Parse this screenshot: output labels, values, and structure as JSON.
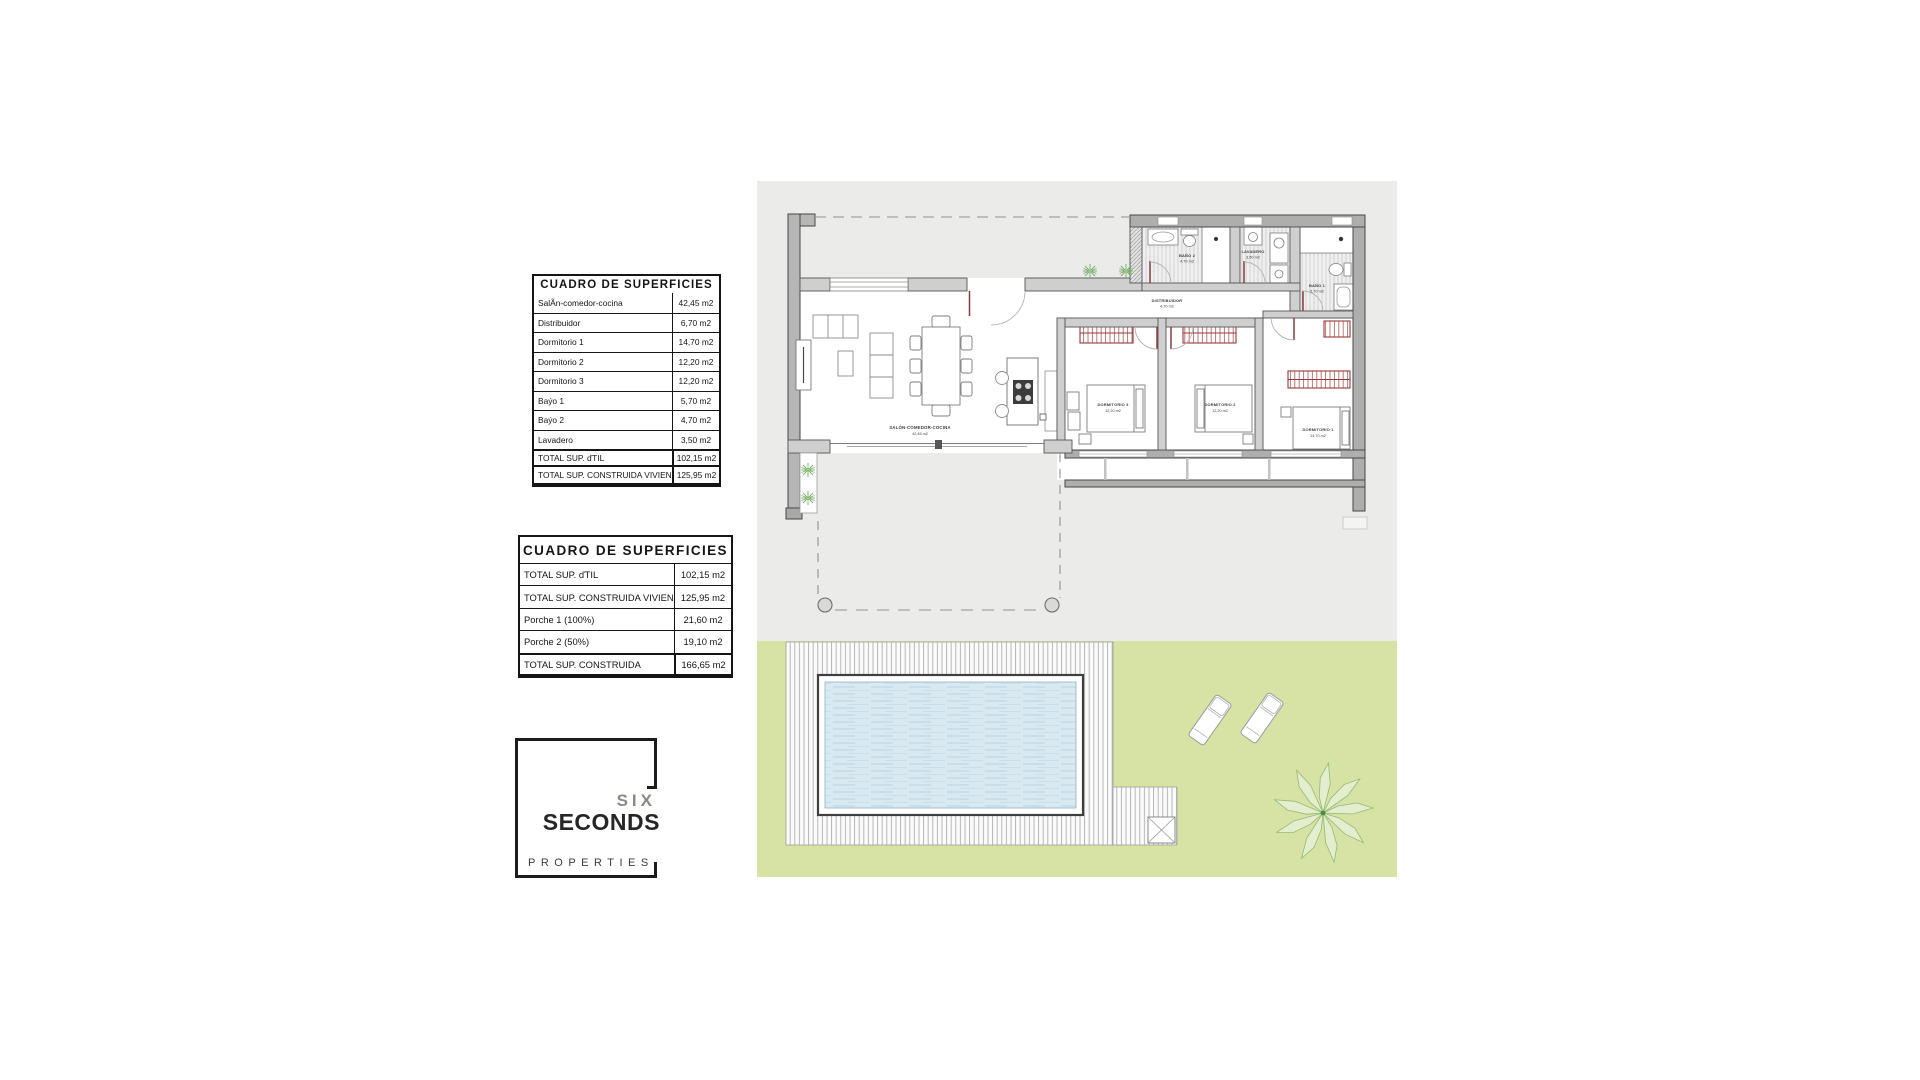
{
  "table1": {
    "title": "CUADRO DE SUPERFICIES",
    "rows": [
      {
        "label": "SalÃn-comedor-cocina",
        "value": "42,45 m2"
      },
      {
        "label": "Distribuidor",
        "value": "6,70 m2"
      },
      {
        "label": "Dormitorio 1",
        "value": "14,70 m2"
      },
      {
        "label": "Dormitorio 2",
        "value": "12,20 m2"
      },
      {
        "label": "Dormitorio 3",
        "value": "12,20 m2"
      },
      {
        "label": "Baýo 1",
        "value": "5,70 m2"
      },
      {
        "label": "Baýo 2",
        "value": "4,70 m2"
      },
      {
        "label": "Lavadero",
        "value": "3,50 m2"
      }
    ],
    "totals": [
      {
        "label": "TOTAL SUP. ďTIL",
        "value": "102,15 m2"
      },
      {
        "label": "TOTAL SUP. CONSTRUIDA VIVIENDA",
        "value": "125,95 m2"
      }
    ]
  },
  "table2": {
    "title": "CUADRO DE SUPERFICIES",
    "rows": [
      {
        "label": "TOTAL SUP. ďTIL",
        "value": "102,15 m2"
      },
      {
        "label": "TOTAL SUP. CONSTRUIDA VIVIENDA",
        "value": "125,95 m2"
      },
      {
        "label": "Porche 1 (100%)",
        "value": "21,60 m2"
      },
      {
        "label": "Porche 2 (50%)",
        "value": "19,10 m2"
      }
    ],
    "total": {
      "label": "TOTAL SUP. CONSTRUIDA",
      "value": "166,65 m2"
    }
  },
  "logo": {
    "six": "SIX",
    "seconds": "SECONDS",
    "properties": "PROPERTIES"
  },
  "plan": {
    "rooms": [
      {
        "name": "SALÓN-COMEDOR-COCINA",
        "area": "42,45 m2"
      },
      {
        "name": "DISTRIBUIDOR",
        "area": "4,70 m2"
      },
      {
        "name": "BAÑO 2",
        "area": "4,70 m2"
      },
      {
        "name": "LAVADERO",
        "area": "3,50 m2"
      },
      {
        "name": "BAÑO 1",
        "area": "5,70 m2"
      },
      {
        "name": "DORMITORIO 3",
        "area": "12,20 m2"
      },
      {
        "name": "DORMITORIO 2",
        "area": "12,20 m2"
      },
      {
        "name": "DORMITORIO 1",
        "area": "14,70 m2"
      }
    ],
    "colors": {
      "panel_gray": "#ebebea",
      "garden_green": "#d6e3a5",
      "pool_water": "#d9e9f1",
      "wall_gray": "#b6b6b6",
      "accent_red": "#9b3a3a",
      "plant_green": "#76ad68"
    }
  }
}
